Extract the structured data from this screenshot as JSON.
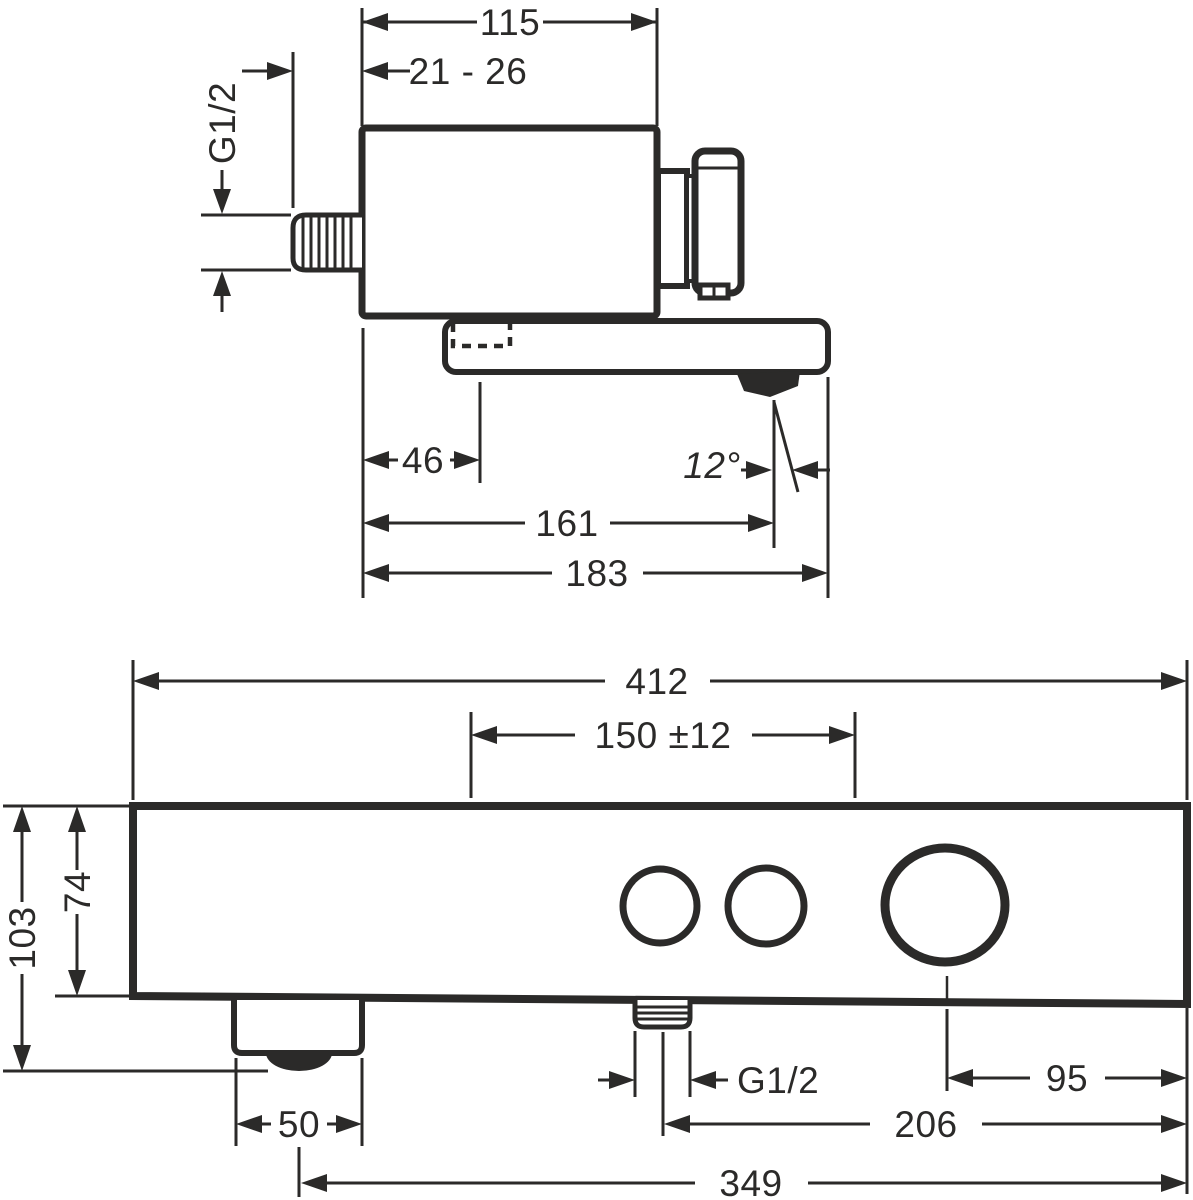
{
  "drawing_type": "technical dimension drawing, bath mixer, side view and front view",
  "colors": {
    "ink": "#2b2a29",
    "background": "#ffffff"
  },
  "side_view": {
    "dims": {
      "top_width": "115",
      "wall_depth_range": "21 - 26",
      "supply_thread": "G1/2",
      "hole_offset": "46",
      "spout_angle": "12°",
      "outlet_reach": "161",
      "total_reach": "183"
    }
  },
  "front_view": {
    "dims": {
      "total_width": "412",
      "center_spacing": "150 ±12",
      "total_height": "103",
      "body_height": "74",
      "foot_width": "50",
      "outlet_thread": "G1/2",
      "knob_offset": "95",
      "outlet_offset": "206",
      "foot_offset": "349"
    }
  }
}
